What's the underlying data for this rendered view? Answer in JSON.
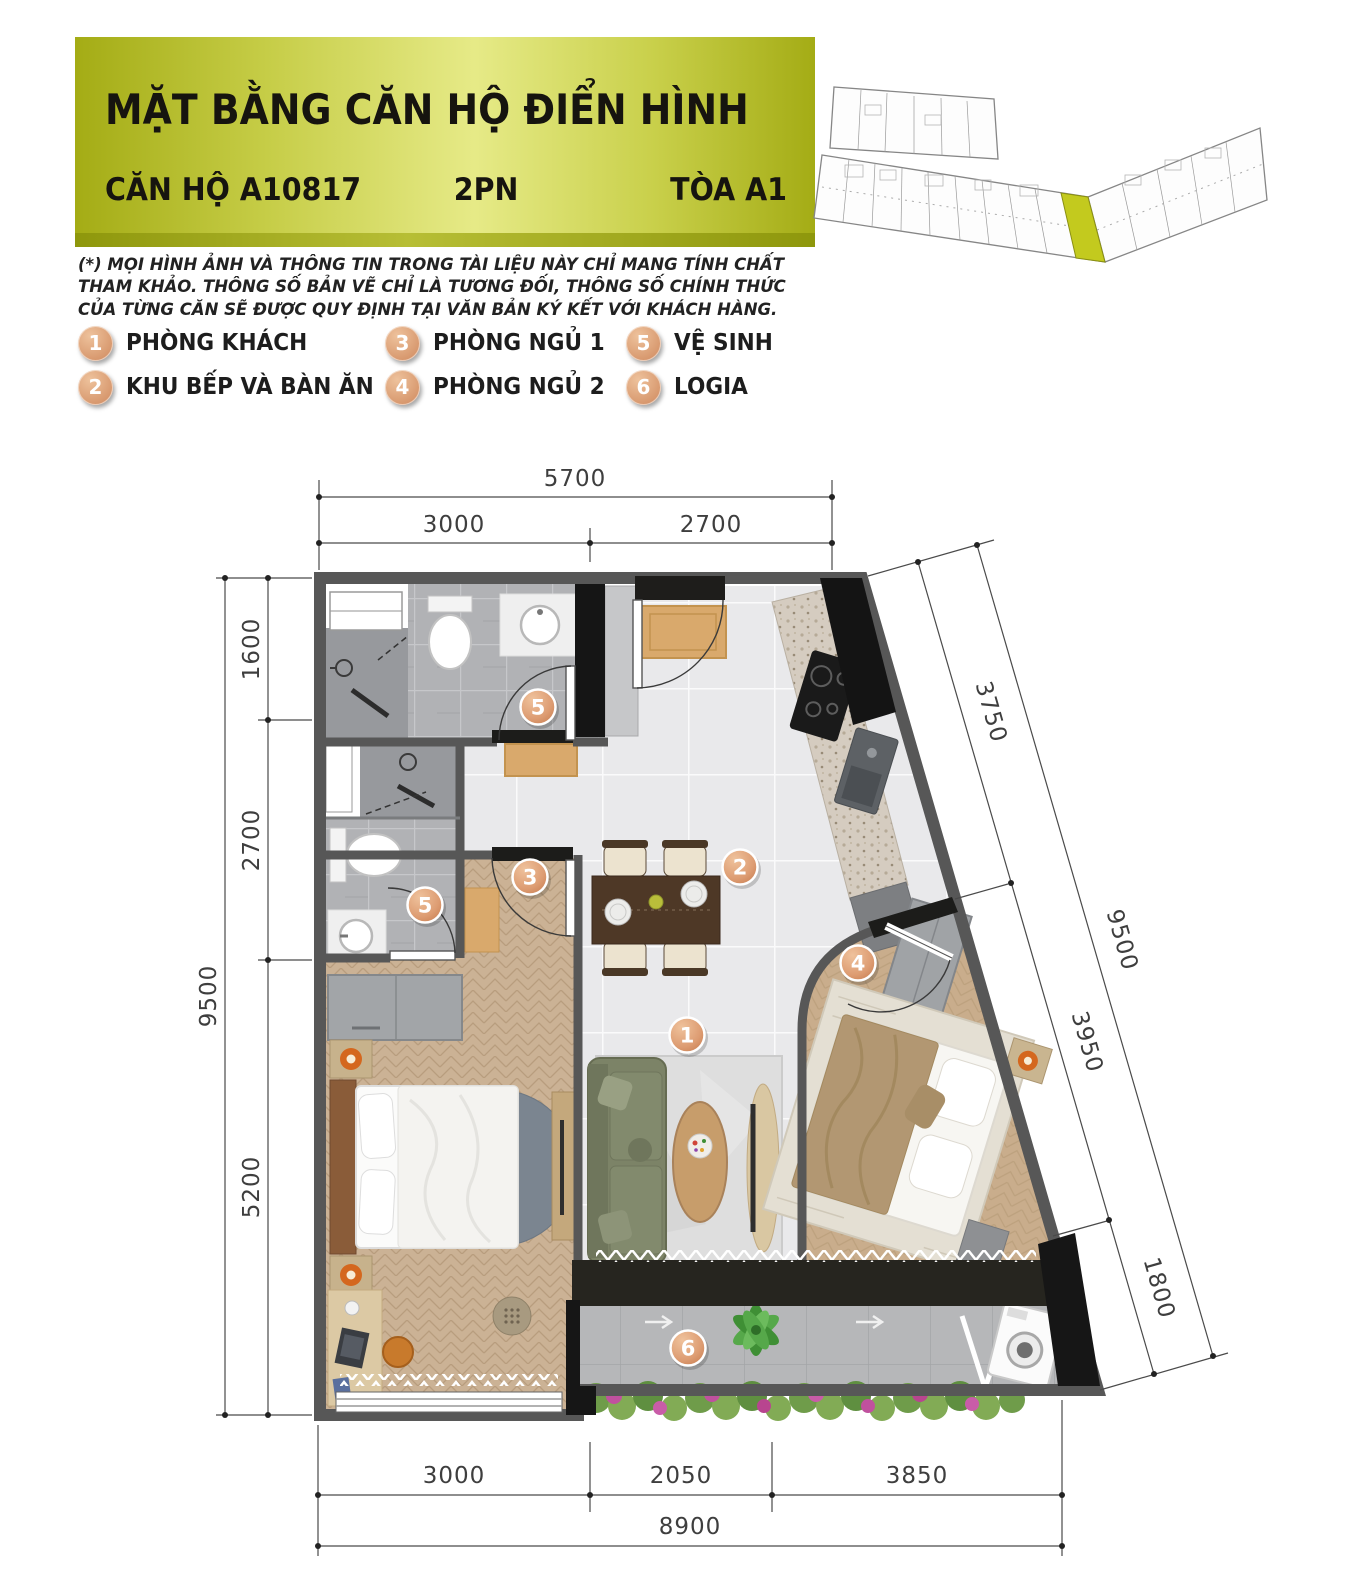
{
  "header": {
    "title": "MẶT BẰNG CĂN HỘ ĐIỂN HÌNH",
    "unit": "CĂN HỘ A10817",
    "bedrooms": "2PN",
    "tower": "TÒA A1"
  },
  "disclaimer": "(*) MỌI HÌNH ẢNH VÀ THÔNG TIN TRONG TÀI LIỆU NÀY CHỈ MANG TÍNH  CHẤT THAM KHẢO. THÔNG SỐ BẢN VẼ CHỈ LÀ TƯƠNG ĐỐI, THÔNG SỐ CHÍNH THỨC CỦA TỪNG CĂN SẼ ĐƯỢC QUY ĐỊNH TẠI VĂN BẢN KÝ KẾT VỚI KHÁCH HÀNG.",
  "legend": {
    "items": [
      {
        "num": "1",
        "label": "PHÒNG KHÁCH"
      },
      {
        "num": "2",
        "label": "KHU BẾP VÀ BÀN ĂN"
      },
      {
        "num": "3",
        "label": "PHÒNG NGỦ 1"
      },
      {
        "num": "4",
        "label": "PHÒNG NGỦ 2"
      },
      {
        "num": "5",
        "label": "VỆ SINH"
      },
      {
        "num": "6",
        "label": "LOGIA"
      }
    ]
  },
  "colors": {
    "header_gradient_dark": "#a4ac15",
    "header_gradient_light": "#e6ea87",
    "header_strip": "#8e970c",
    "marker_fill": "#dfa183",
    "overview_highlight": "#c3ca1e",
    "wall": "#575757"
  },
  "plan": {
    "markers": [
      {
        "num": "1",
        "room": "phong-khach"
      },
      {
        "num": "2",
        "room": "khu-bep-va-ban-an"
      },
      {
        "num": "3",
        "room": "phong-ngu-1"
      },
      {
        "num": "4",
        "room": "phong-ngu-2"
      },
      {
        "num": "5",
        "room": "ve-sinh-1"
      },
      {
        "num": "5",
        "room": "ve-sinh-2"
      },
      {
        "num": "6",
        "room": "logia"
      }
    ],
    "dims": {
      "top": {
        "total": "5700",
        "segs": [
          "3000",
          "2700"
        ]
      },
      "left": {
        "total": "9500",
        "segs": [
          "1600",
          "2700",
          "5200"
        ]
      },
      "right": {
        "total": "9500",
        "segs": [
          "3750",
          "3950",
          "1800"
        ]
      },
      "bottom": {
        "total": "8900",
        "segs": [
          "3000",
          "2050",
          "3850"
        ]
      }
    }
  }
}
